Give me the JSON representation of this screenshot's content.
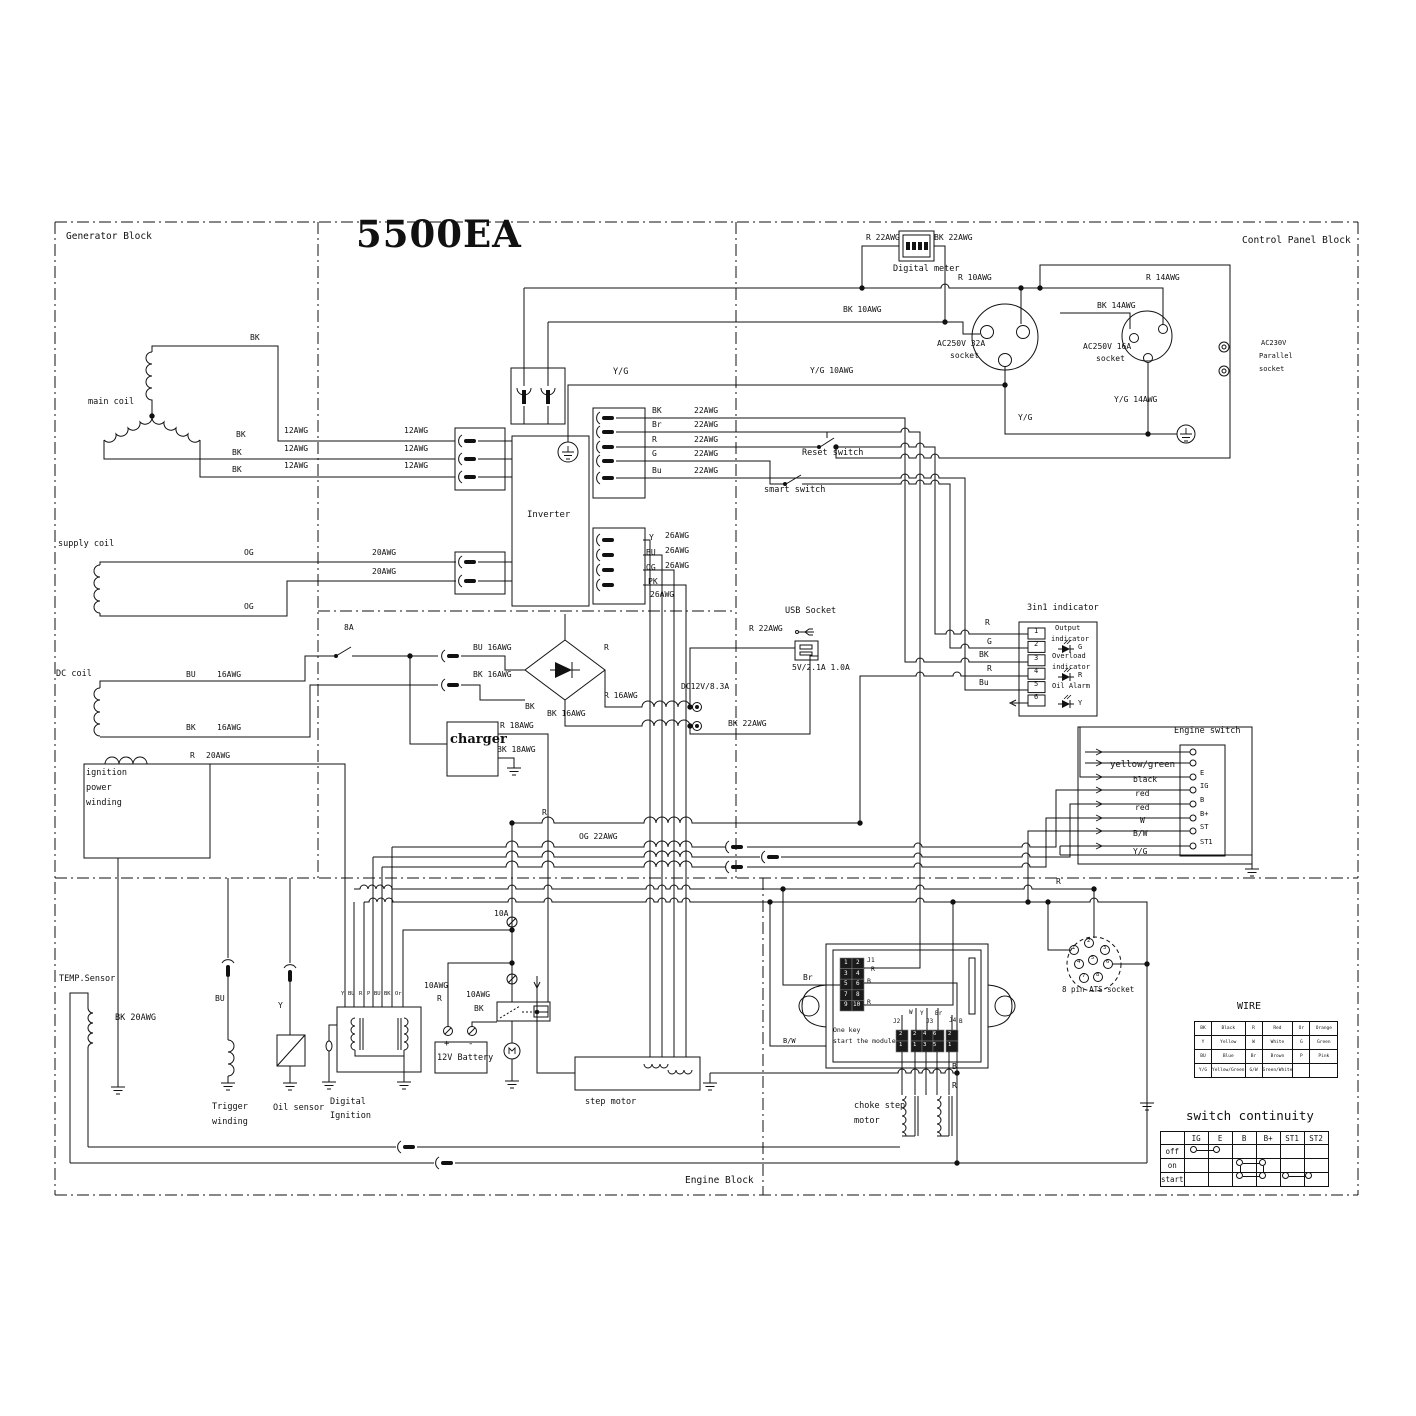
{
  "title": "5500EA",
  "blocks": {
    "generator": "Generator Block",
    "control_panel": "Control Panel Block",
    "engine": "Engine Block"
  },
  "labels": [
    [
      "R  22AWG",
      866,
      234
    ],
    [
      "BK 22AWG",
      934,
      234
    ],
    [
      "Digital meter",
      893,
      265,
      8.5
    ],
    [
      "R   10AWG",
      958,
      274
    ],
    [
      "R   14AWG",
      1146,
      274
    ],
    [
      "BK  10AWG",
      843,
      306
    ],
    [
      "BK  14AWG",
      1097,
      302
    ],
    [
      "BK",
      250,
      334
    ],
    [
      "AC250V 32A",
      937,
      340
    ],
    [
      "socket",
      950,
      352
    ],
    [
      "AC250V 16A",
      1083,
      343
    ],
    [
      "socket",
      1096,
      355
    ],
    [
      "AC230V",
      1261,
      340,
      7
    ],
    [
      "Parallel",
      1259,
      353,
      7
    ],
    [
      "socket",
      1259,
      366,
      7
    ],
    [
      "Y/G",
      613,
      368,
      8.5
    ],
    [
      "Y/G 10AWG",
      810,
      367
    ],
    [
      "main coil",
      88,
      398,
      8.5
    ],
    [
      "Y/G 14AWG",
      1114,
      396
    ],
    [
      "Y/G",
      1018,
      414
    ],
    [
      "BK",
      652,
      407
    ],
    [
      "22AWG",
      694,
      407
    ],
    [
      "Br",
      652,
      421
    ],
    [
      "22AWG",
      694,
      421
    ],
    [
      "R",
      652,
      436
    ],
    [
      "22AWG",
      694,
      436
    ],
    [
      "G",
      652,
      450
    ],
    [
      "22AWG",
      694,
      450
    ],
    [
      "Bu",
      652,
      467
    ],
    [
      "22AWG",
      694,
      467
    ],
    [
      "BK",
      236,
      431
    ],
    [
      "12AWG",
      284,
      427
    ],
    [
      "12AWG",
      404,
      427
    ],
    [
      "BK",
      232,
      449
    ],
    [
      "12AWG",
      284,
      445
    ],
    [
      "12AWG",
      404,
      445
    ],
    [
      "BK",
      232,
      466
    ],
    [
      "12AWG",
      284,
      462
    ],
    [
      "12AWG",
      404,
      462
    ],
    [
      "Reset switch",
      802,
      449,
      8.5
    ],
    [
      "smart switch",
      764,
      486,
      8.5
    ],
    [
      "Inverter",
      527,
      511,
      9
    ],
    [
      "Y",
      649,
      534
    ],
    [
      "26AWG",
      665,
      532
    ],
    [
      "BU",
      646,
      549
    ],
    [
      "26AWG",
      665,
      547
    ],
    [
      "OG",
      646,
      564
    ],
    [
      "26AWG",
      665,
      562
    ],
    [
      "PK",
      648,
      578
    ],
    [
      "26AWG",
      650,
      591
    ],
    [
      "supply coil",
      58,
      540,
      8.5
    ],
    [
      "OG",
      244,
      549
    ],
    [
      "20AWG",
      372,
      549
    ],
    [
      "20AWG",
      372,
      568
    ],
    [
      "OG",
      244,
      603
    ],
    [
      "8A",
      344,
      624
    ],
    [
      "USB Socket",
      785,
      607,
      8.5
    ],
    [
      "R  22AWG",
      749,
      625
    ],
    [
      "DC coil",
      56,
      670,
      8.5
    ],
    [
      "BU",
      186,
      671
    ],
    [
      "16AWG",
      217,
      671
    ],
    [
      "BK",
      186,
      724
    ],
    [
      "16AWG",
      217,
      724
    ],
    [
      "3in1 indicator",
      1027,
      604,
      8.5
    ],
    [
      "5V/2.1A 1.0A",
      792,
      664
    ],
    [
      "BU 16AWG",
      473,
      644
    ],
    [
      "BK 16AWG",
      473,
      671
    ],
    [
      "R",
      604,
      644
    ],
    [
      "R  16AWG",
      604,
      692
    ],
    [
      "DC12V/8.3A",
      681,
      683
    ],
    [
      "R",
      985,
      619
    ],
    [
      "G",
      987,
      638
    ],
    [
      "BK",
      979,
      651
    ],
    [
      "R",
      987,
      665
    ],
    [
      "Bu",
      979,
      679
    ],
    [
      "1",
      1034,
      628,
      7
    ],
    [
      "2",
      1034,
      641,
      7
    ],
    [
      "3",
      1034,
      655,
      7
    ],
    [
      "4",
      1034,
      668,
      7
    ],
    [
      "5",
      1034,
      681,
      7
    ],
    [
      "6",
      1034,
      694,
      7
    ],
    [
      "Output",
      1055,
      625,
      7
    ],
    [
      "indicator",
      1051,
      636,
      7
    ],
    [
      "G",
      1078,
      644,
      7
    ],
    [
      "Overload",
      1052,
      653,
      7
    ],
    [
      "indicator",
      1052,
      664,
      7
    ],
    [
      "R",
      1078,
      672,
      7
    ],
    [
      "Oil Alarm",
      1052,
      683,
      7
    ],
    [
      "Y",
      1078,
      700,
      7
    ],
    [
      "BK",
      525,
      703
    ],
    [
      "BK 16AWG",
      547,
      710
    ],
    [
      "BK 22AWG",
      728,
      720
    ],
    [
      "R 18AWG",
      500,
      722
    ],
    [
      "BK 18AWG",
      497,
      746
    ],
    [
      "charger",
      450,
      733,
      13,
      "s"
    ],
    [
      "R",
      190,
      752
    ],
    [
      "20AWG",
      206,
      752
    ],
    [
      "ignition",
      86,
      769,
      8.5
    ],
    [
      "power",
      86,
      784,
      8.5
    ],
    [
      "winding",
      86,
      799,
      8.5
    ],
    [
      "Engine switch",
      1174,
      727,
      8.5
    ],
    [
      "yellow/green",
      1110,
      761,
      9
    ],
    [
      "black",
      1133,
      776
    ],
    [
      "red",
      1135,
      790
    ],
    [
      "red",
      1135,
      804
    ],
    [
      "W",
      1140,
      817
    ],
    [
      "B/W",
      1133,
      830
    ],
    [
      "Y/G",
      1133,
      848
    ],
    [
      "E",
      1200,
      770,
      7
    ],
    [
      "IG",
      1200,
      783,
      7
    ],
    [
      "B",
      1200,
      797,
      7
    ],
    [
      "B+",
      1200,
      811,
      7
    ],
    [
      "ST",
      1200,
      824,
      7
    ],
    [
      "ST1",
      1200,
      839,
      7
    ],
    [
      "R",
      542,
      809
    ],
    [
      "OG 22AWG",
      579,
      833
    ],
    [
      "R",
      1056,
      878
    ],
    [
      "8 pin ATS socket",
      1062,
      986,
      7.5
    ],
    [
      "10A",
      494,
      910
    ],
    [
      "10AWG",
      424,
      982
    ],
    [
      "R",
      437,
      995
    ],
    [
      "10AWG",
      466,
      991
    ],
    [
      "BK",
      474,
      1005
    ],
    [
      "TEMP.Sensor",
      59,
      975,
      8.5
    ],
    [
      "BK  20AWG",
      115,
      1014,
      8.5
    ],
    [
      "BU",
      215,
      995
    ],
    [
      "Y",
      278,
      1002
    ],
    [
      "Y",
      341,
      992,
      5.5
    ],
    [
      "BU",
      348,
      992,
      5.5
    ],
    [
      "R",
      359,
      992,
      5.5
    ],
    [
      "P",
      367,
      992,
      5.5
    ],
    [
      "BU",
      374,
      992,
      5.5
    ],
    [
      "BK",
      384,
      992,
      5.5
    ],
    [
      "Or",
      395,
      992,
      5.5
    ],
    [
      "+",
      444,
      1040,
      9
    ],
    [
      "-",
      468,
      1040,
      9
    ],
    [
      "12V Battery",
      437,
      1054,
      8.5
    ],
    [
      "Trigger",
      212,
      1103,
      8.5
    ],
    [
      "winding",
      212,
      1118,
      8.5
    ],
    [
      "Oil sensor",
      273,
      1104,
      8.5
    ],
    [
      "Digital",
      330,
      1098,
      8.5
    ],
    [
      "Ignition",
      330,
      1112,
      8.5
    ],
    [
      "step motor",
      585,
      1098,
      8.5
    ],
    [
      "One key",
      833,
      1027,
      6.5
    ],
    [
      "start the module",
      833,
      1038,
      6.5
    ],
    [
      "J1",
      867,
      957,
      6.5
    ],
    [
      "R",
      871,
      966,
      6.5
    ],
    [
      "B",
      867,
      978,
      6.5
    ],
    [
      "R",
      867,
      999,
      6.5
    ],
    [
      "Br",
      803,
      974
    ],
    [
      "B/W",
      783,
      1038,
      7
    ],
    [
      "1",
      844,
      960,
      6,
      "w"
    ],
    [
      "2",
      856,
      960,
      6,
      "w"
    ],
    [
      "3",
      844,
      971,
      6,
      "w"
    ],
    [
      "4",
      856,
      971,
      6,
      "w"
    ],
    [
      "5",
      844,
      981,
      6,
      "w"
    ],
    [
      "6",
      856,
      981,
      6,
      "w"
    ],
    [
      "7",
      844,
      992,
      6,
      "w"
    ],
    [
      "8",
      856,
      992,
      6,
      "w"
    ],
    [
      "9",
      844,
      1002,
      6,
      "w"
    ],
    [
      "10",
      853,
      1002,
      6,
      "w"
    ],
    [
      "J2",
      893,
      1019,
      6
    ],
    [
      "W",
      909,
      1010,
      6
    ],
    [
      "Y",
      920,
      1011,
      6
    ],
    [
      "J3",
      926,
      1019,
      6
    ],
    [
      "Br",
      935,
      1011,
      6
    ],
    [
      "J4",
      949,
      1018,
      6
    ],
    [
      "B",
      959,
      1019,
      6
    ],
    [
      "2",
      899,
      1032,
      5.5,
      "w"
    ],
    [
      "1",
      899,
      1043,
      5.5,
      "w"
    ],
    [
      "2",
      913,
      1032,
      5.5,
      "w"
    ],
    [
      "4",
      923,
      1032,
      5.5,
      "w"
    ],
    [
      "6",
      933,
      1032,
      5.5,
      "w"
    ],
    [
      "1",
      913,
      1043,
      5.5,
      "w"
    ],
    [
      "3",
      923,
      1043,
      5.5,
      "w"
    ],
    [
      "5",
      933,
      1043,
      5.5,
      "w"
    ],
    [
      "2",
      948,
      1032,
      5.5,
      "w"
    ],
    [
      "1",
      948,
      1043,
      5.5,
      "w"
    ],
    [
      "B",
      952,
      1063
    ],
    [
      "R",
      952,
      1082
    ],
    [
      "choke step",
      854,
      1102,
      8.5
    ],
    [
      "motor",
      854,
      1117,
      8.5
    ],
    [
      "1",
      1072,
      946,
      5.5
    ],
    [
      "2",
      1087,
      939,
      5.5
    ],
    [
      "3",
      1103,
      946,
      5.5
    ],
    [
      "4",
      1077,
      960,
      5.5
    ],
    [
      "5",
      1091,
      956,
      5.5
    ],
    [
      "6",
      1106,
      960,
      5.5
    ],
    [
      "7",
      1082,
      974,
      5.5
    ],
    [
      "8",
      1096,
      973,
      5.5
    ]
  ],
  "wire_table": {
    "title": "WIRE",
    "rows": [
      [
        "BK",
        "Black",
        "R",
        "Red",
        "Or",
        "Orange"
      ],
      [
        "Y",
        "Yellow",
        "W",
        "White",
        "G",
        "Green"
      ],
      [
        "BU",
        "Blue",
        "Br",
        "Brown",
        "P",
        "Pink"
      ],
      [
        "Y/G",
        "Yellow/Green",
        "G/W",
        "Green/White",
        "",
        ""
      ]
    ]
  },
  "continuity": {
    "title": "switch continuity",
    "columns": [
      "",
      "IG",
      "E",
      "B",
      "B+",
      "ST1",
      "ST2"
    ],
    "rows": [
      "off",
      "on",
      "start"
    ],
    "links": [
      {
        "row": "off",
        "from": "IG",
        "to": "E"
      },
      {
        "row": "on",
        "from": "B",
        "to": "B+"
      },
      {
        "row": "start",
        "from": "B",
        "to": "B+"
      },
      {
        "row": "start",
        "from": "ST1",
        "to": "ST2"
      }
    ],
    "vlinks": [
      {
        "col": "B",
        "rows": [
          "on",
          "start"
        ]
      },
      {
        "col": "B+",
        "rows": [
          "on",
          "start"
        ]
      }
    ]
  }
}
